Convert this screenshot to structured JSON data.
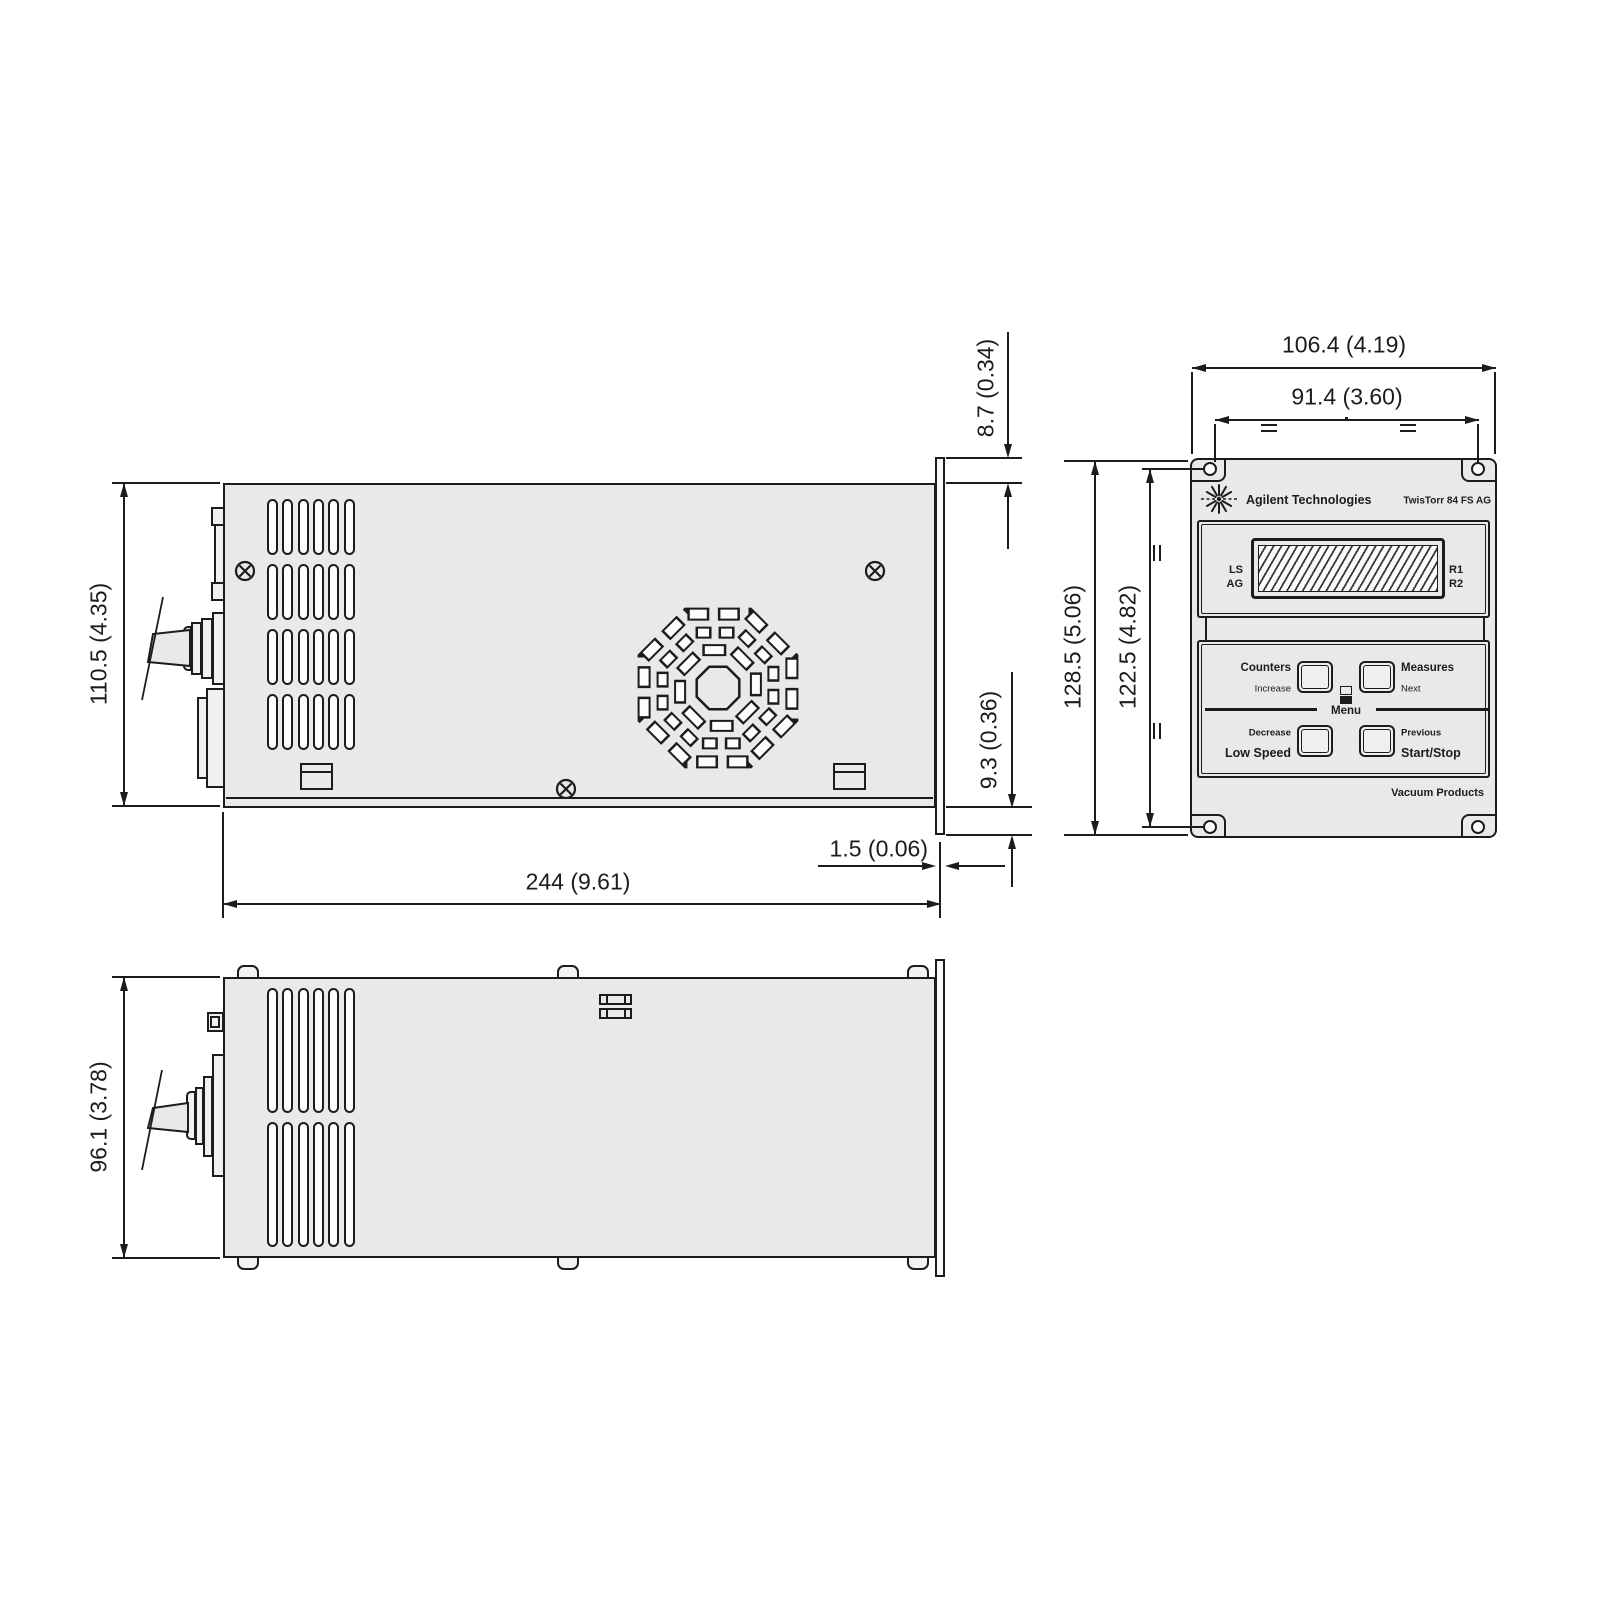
{
  "drawing": {
    "side_view": {
      "dim_height": "110.5 (4.35)",
      "dim_flange_top": "8.7 (0.34)",
      "dim_flange_bottom": "9.3 (0.36)",
      "dim_flange_thickness": "1.5 (0.06)",
      "dim_width": "244 (9.61)"
    },
    "top_view": {
      "dim_height": "96.1 (3.78)"
    },
    "front_view": {
      "dim_outer_width": "106.4 (4.19)",
      "dim_hole_span_h": "91.4 (3.60)",
      "dim_outer_height": "128.5 (5.06)",
      "dim_hole_span_v": "122.5 (4.82)",
      "panel": {
        "brand": "Agilent Technologies",
        "model": "TwisTorr 84 FS AG",
        "lcd_left_top": "LS",
        "lcd_left_bottom": "AG",
        "lcd_right_top": "R1",
        "lcd_right_bottom": "R2",
        "btn1_label": "Counters",
        "btn1_sub": "Increase",
        "btn2_label": "Measures",
        "btn2_sub": "Next",
        "menu_label": "Menu",
        "btn3_sub": "Decrease",
        "btn3_label": "Low Speed",
        "btn4_sub": "Previous",
        "btn4_label": "Start/Stop",
        "footer": "Vacuum Products"
      }
    },
    "colors": {
      "line": "#1c1c1c",
      "body_fill": "#e9e9e9"
    },
    "icons": {
      "screw": "circle-x-screw",
      "fan": "octagon-fan-grille",
      "logo": "agilent-starburst"
    }
  }
}
